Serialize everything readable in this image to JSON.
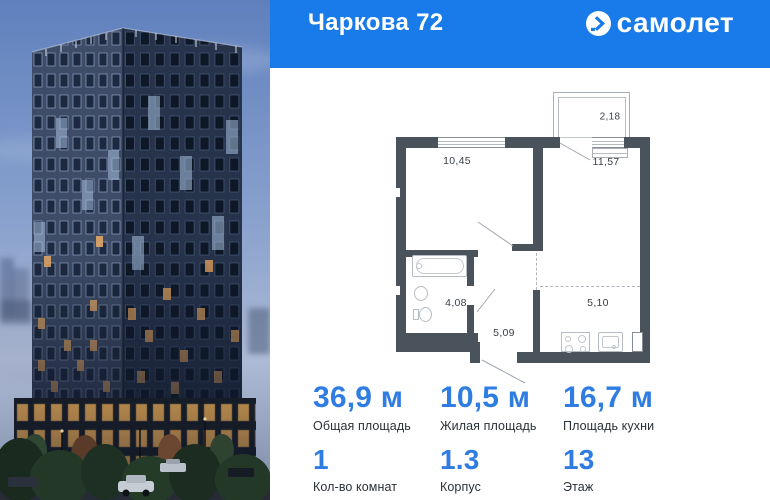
{
  "header": {
    "title": "Чаркова 72",
    "brand": "самолет"
  },
  "floorplan": {
    "areas": {
      "balcony": "2,18",
      "living": "10,45",
      "kitchen_living": "11,57",
      "bathroom": "4,08",
      "hallway": "5,09",
      "kitchen_zone": "5,10"
    },
    "fixtures": [
      "bathtub",
      "washbasin",
      "toilet",
      "stove",
      "kitchen-sink"
    ]
  },
  "stats": [
    {
      "value": "36,9 м",
      "label": "Общая площадь"
    },
    {
      "value": "10,5 м",
      "label": "Жилая площадь"
    },
    {
      "value": "16,7 м",
      "label": "Площадь кухни"
    },
    {
      "value": "1",
      "label": "Кол-во комнат"
    },
    {
      "value": "1.3",
      "label": "Корпус"
    },
    {
      "value": "13",
      "label": "Этаж"
    }
  ],
  "colors": {
    "header_bg": "#187BE9",
    "accent_number": "#2F7DE2",
    "wall": "#4A525C",
    "leader_line": "#A0A6AE"
  },
  "icons": {
    "brand_logo": "samolet-arrow-squircle-icon"
  }
}
